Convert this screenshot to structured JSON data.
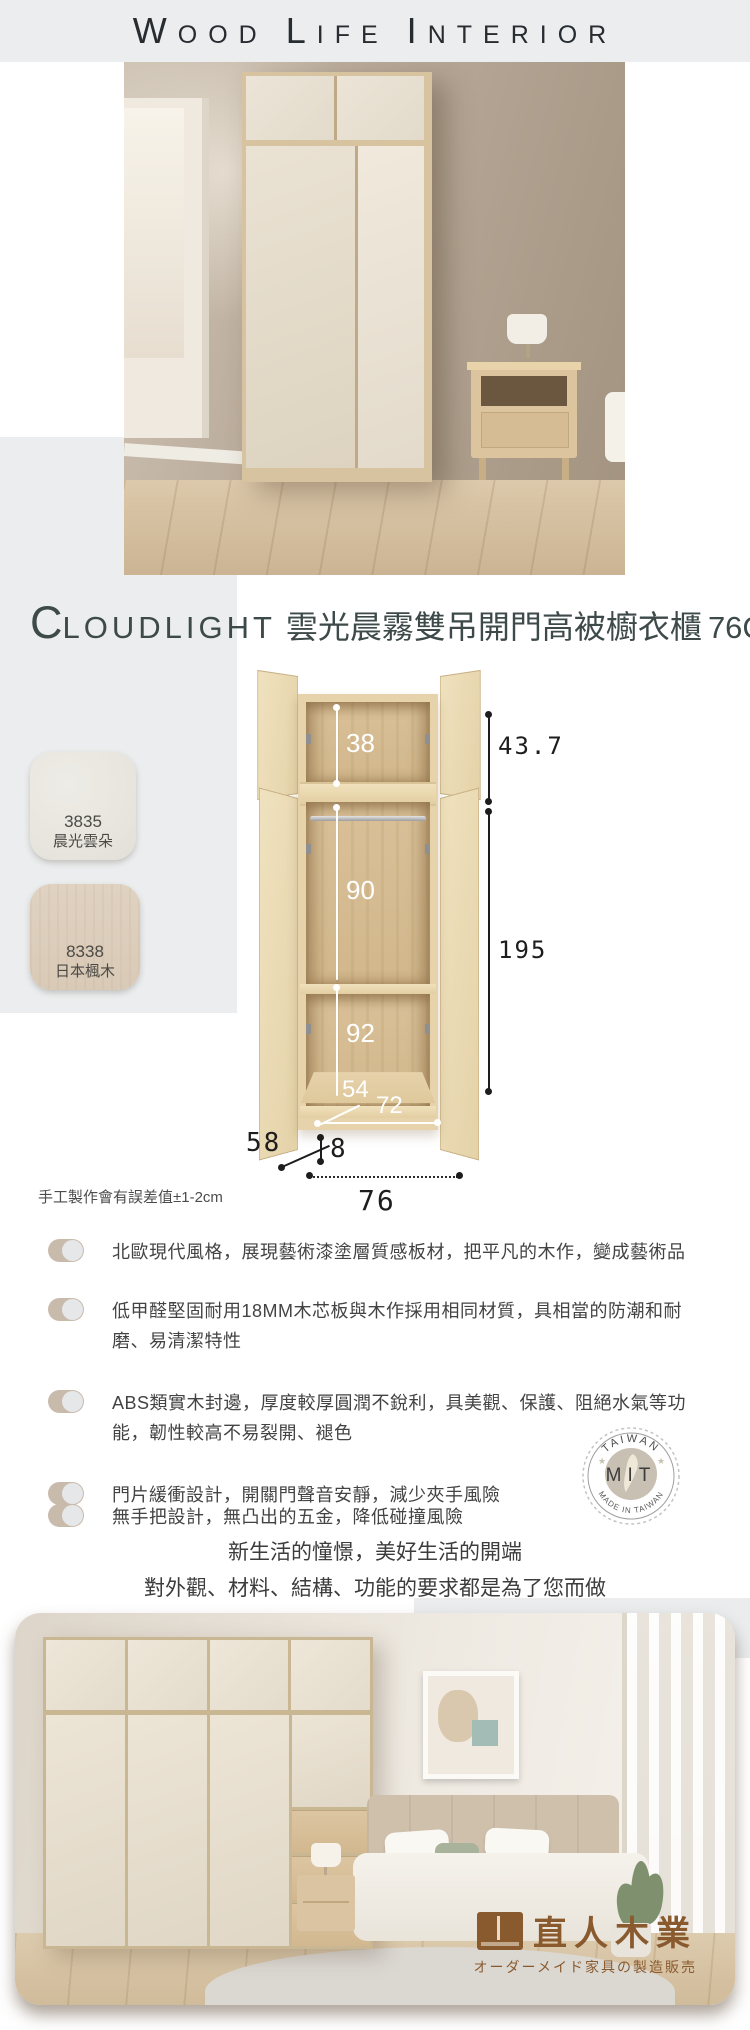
{
  "header": {
    "words": [
      "WOOD",
      "LIFE",
      "INTERIOR"
    ]
  },
  "title": {
    "en_initial": "C",
    "en_rest": "LOUDLIGHT",
    "zh": "雲光晨霧雙吊開門高被櫥衣櫃",
    "size": "76CM"
  },
  "swatches": [
    {
      "code": "3835",
      "name": "晨光雲朵",
      "color": "#e8e6e0"
    },
    {
      "code": "8338",
      "name": "日本楓木",
      "color": "#ddcfbe"
    }
  ],
  "diagram": {
    "dims": {
      "upper_inner_height": "38",
      "middle_inner_height": "90",
      "lower_inner_height": "92",
      "inner_depth": "54",
      "inner_width": "72",
      "upper_cabinet_height": "43.7",
      "body_height": "195",
      "depth": "58",
      "plinth_height": "8",
      "total_width": "76"
    },
    "note": "手工製作會有誤差值±1-2cm"
  },
  "features": [
    "北歐現代風格，展現藝術漆塗層質感板材，把平凡的木作，變成藝術品",
    "低甲醛堅固耐用18MM木芯板與木作採用相同材質，具相當的防潮和耐磨、易清潔特性",
    "ABS類實木封邊，厚度較厚圓潤不銳利，具美觀、保護、阻絕水氣等功能，韌性較高不易裂開、褪色",
    "門片緩衝設計，開關門聲音安靜，減少夾手風險",
    "無手把設計，無凸出的五金，降低碰撞風險"
  ],
  "badge": {
    "arc_top": "TAIWAN",
    "center": "MIT",
    "arc_bottom": "MADE IN TAIWAN"
  },
  "slogans": {
    "line1": "新生活的憧憬，美好生活的開端",
    "line2": "對外觀、材料、結構、功能的要求都是為了您而做"
  },
  "watermark": {
    "brand": "直人木業",
    "tagline": "オーダーメイド家具の製造販売"
  },
  "colors": {
    "band_gray": "#ecedef",
    "accent_gray": "#ebedee",
    "title_text": "#3d4a49",
    "logo_brown": "#8a5a2f",
    "pill_tan": "#c9bbab"
  }
}
